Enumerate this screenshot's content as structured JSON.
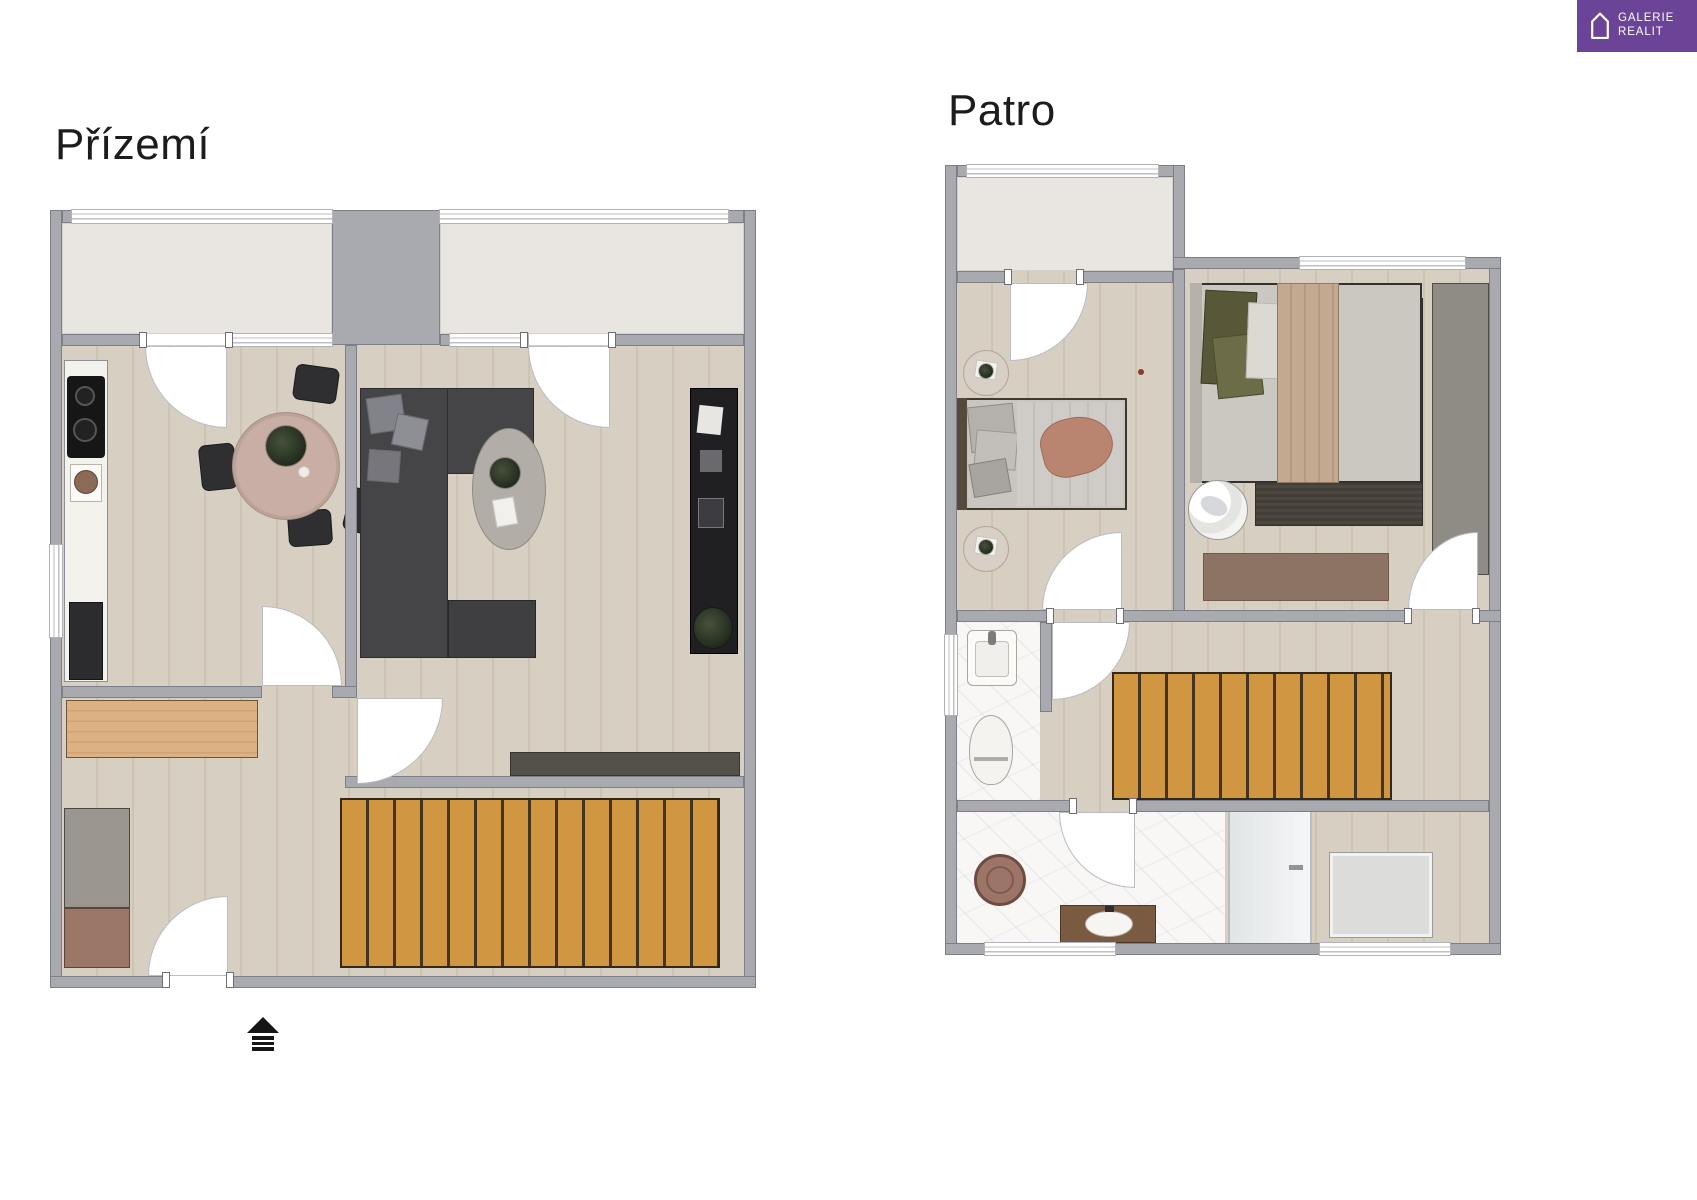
{
  "header": {
    "ground_floor_title": "Přízemí",
    "upper_floor_title": "Patro"
  },
  "logo": {
    "line1": "GALERIE",
    "line2": "REALIT",
    "background_color": "#6b4397",
    "icon": "house-outline-icon"
  },
  "entrance": {
    "symbol": "entrance-arrow-icon"
  },
  "colors": {
    "wall": "#a9a9b0",
    "wood_floor": "#d7cfc1",
    "balcony_floor": "#e9e6e1",
    "stairs_wood": "#d09642",
    "marble_floor": "#f8f7f5",
    "sofa_dark": "#454548",
    "furniture_black": "#202023",
    "bench_wood": "#dcb285",
    "cabinet_gray": "#9a968f",
    "cabinet_brown": "#9a7767",
    "throw_accent": "#b98570",
    "rug_dark": "#4b4540",
    "rug_brown": "#8c7363"
  }
}
